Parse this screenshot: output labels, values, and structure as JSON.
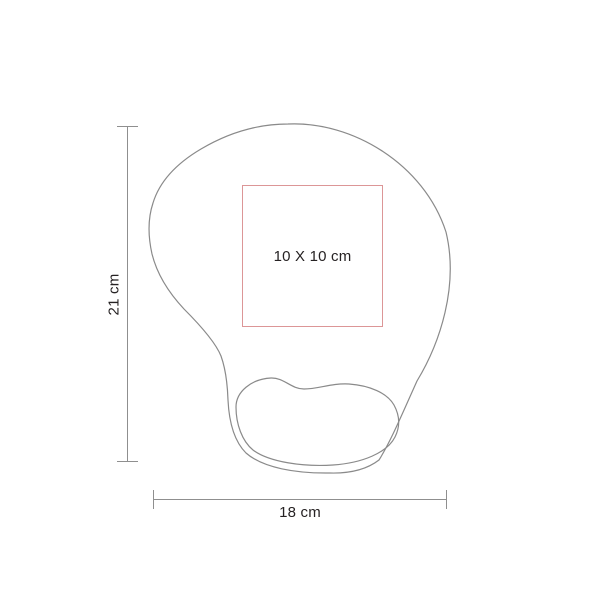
{
  "diagram": {
    "shape_icon": "mousepad-with-wrist-rest-top-view-outline",
    "outline_color": "#8a8a8a",
    "text_color": "#262223",
    "dimension_line_color": "#8f8f8f",
    "print_area": {
      "label": "10 X 10 cm",
      "border_color": "#dc9697"
    },
    "height_dimension": {
      "label": "21 cm"
    },
    "width_dimension": {
      "label": "18 cm"
    }
  }
}
